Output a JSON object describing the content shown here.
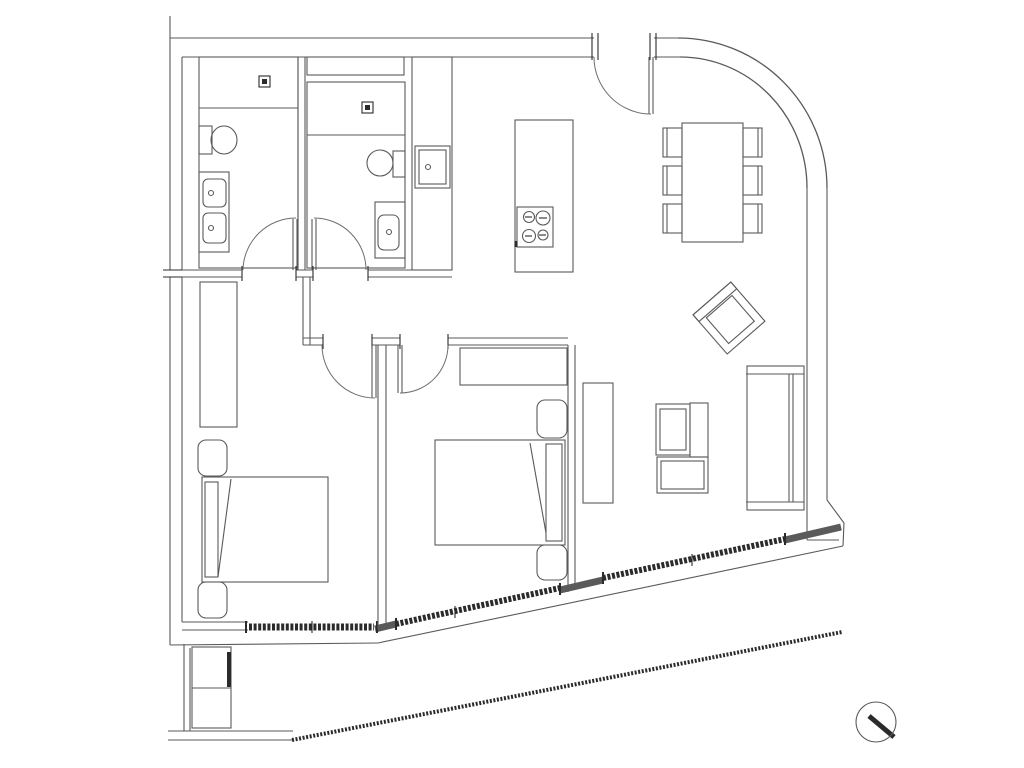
{
  "canvas": {
    "width": 1024,
    "height": 768,
    "background": "#ffffff"
  },
  "style": {
    "line_color": "#5a5a5a",
    "dark_color": "#2b2b2b",
    "arc_color": "#6e6e6e",
    "line_width": 1.1
  },
  "transforms": {
    "armchair": "translate(729,318) rotate(49)"
  },
  "lines": [
    {
      "n": "top-wall-outer-left",
      "x1": 170,
      "y1": 38,
      "x2": 594,
      "y2": 38
    },
    {
      "n": "top-wall-inner-left",
      "x1": 182,
      "y1": 57,
      "x2": 594,
      "y2": 57
    },
    {
      "n": "top-wall-outer-right",
      "x1": 654,
      "y1": 38,
      "x2": 678,
      "y2": 38
    },
    {
      "n": "top-wall-inner-right",
      "x1": 654,
      "y1": 57,
      "x2": 680,
      "y2": 57
    },
    {
      "n": "party-wall-stub",
      "x1": 170,
      "y1": 16,
      "x2": 170,
      "y2": 38
    },
    {
      "n": "left-wall-outer-upper",
      "x1": 170,
      "y1": 38,
      "x2": 170,
      "y2": 270
    },
    {
      "n": "left-wall-outer-lower",
      "x1": 170,
      "y1": 277,
      "x2": 170,
      "y2": 645
    },
    {
      "n": "left-wall-inner-upper",
      "x1": 182,
      "y1": 57,
      "x2": 182,
      "y2": 270
    },
    {
      "n": "left-wall-inner-lower",
      "x1": 182,
      "y1": 277,
      "x2": 182,
      "y2": 622
    },
    {
      "n": "left-wall-break-tick-a",
      "x1": 163,
      "y1": 270,
      "x2": 189,
      "y2": 270,
      "d": 1
    },
    {
      "n": "left-wall-break-tick-b",
      "x1": 163,
      "y1": 277,
      "x2": 189,
      "y2": 277,
      "d": 1
    },
    {
      "n": "right-wall-outer",
      "x1": 827,
      "y1": 188,
      "x2": 827,
      "y2": 500
    },
    {
      "n": "right-wall-inner",
      "x1": 807,
      "y1": 188,
      "x2": 807,
      "y2": 540
    },
    {
      "n": "se-corner-outer",
      "x1": 827,
      "y1": 500,
      "x2": 844,
      "y2": 523
    },
    {
      "n": "se-corner-side",
      "x1": 844,
      "y1": 523,
      "x2": 843,
      "y2": 546
    },
    {
      "n": "se-corner-inner",
      "x1": 807,
      "y1": 540,
      "x2": 839,
      "y2": 540
    },
    {
      "n": "facade-outer-west",
      "x1": 170,
      "y1": 645,
      "x2": 378,
      "y2": 643
    },
    {
      "n": "facade-outer-diag",
      "x1": 378,
      "y1": 643,
      "x2": 843,
      "y2": 546
    },
    {
      "n": "bed1-south-wall-top",
      "x1": 182,
      "y1": 622,
      "x2": 248,
      "y2": 622
    },
    {
      "n": "bed1-south-wall-bot",
      "x1": 182,
      "y1": 630,
      "x2": 248,
      "y2": 630
    },
    {
      "n": "facade-wall-piece-a",
      "x1": 375,
      "y1": 629,
      "x2": 396,
      "y2": 624,
      "w": 7
    },
    {
      "n": "facade-wall-piece-b",
      "x1": 560,
      "y1": 590,
      "x2": 603,
      "y2": 580,
      "w": 7
    },
    {
      "n": "facade-wall-piece-c",
      "x1": 785,
      "y1": 540,
      "x2": 841,
      "y2": 527,
      "w": 7
    },
    {
      "n": "window-bedroom1-band",
      "x1": 249,
      "y1": 627,
      "x2": 374,
      "y2": 627,
      "w": 7,
      "d": 1,
      "dash": "3 1.6"
    },
    {
      "n": "window-bedroom1-cap-left",
      "x1": 246,
      "y1": 621,
      "x2": 246,
      "y2": 633,
      "d": 1,
      "w": 2
    },
    {
      "n": "window-bedroom1-cap-right",
      "x1": 377,
      "y1": 621,
      "x2": 377,
      "y2": 633,
      "d": 1,
      "w": 2
    },
    {
      "n": "window-bedroom1-mullion",
      "x1": 312,
      "y1": 621,
      "x2": 312,
      "y2": 633,
      "d": 1
    },
    {
      "n": "window-bedroom2-band",
      "x1": 396,
      "y1": 624,
      "x2": 560,
      "y2": 588,
      "w": 6,
      "d": 1,
      "dash": "3 1.6"
    },
    {
      "n": "window-bedroom2-cap-left",
      "x1": 396,
      "y1": 618,
      "x2": 396,
      "y2": 630,
      "d": 1,
      "w": 2
    },
    {
      "n": "window-bedroom2-cap-right",
      "x1": 560,
      "y1": 583,
      "x2": 560,
      "y2": 595,
      "d": 1,
      "w": 2
    },
    {
      "n": "window-bedroom2-mullion",
      "x1": 455,
      "y1": 606,
      "x2": 455,
      "y2": 618,
      "d": 1
    },
    {
      "n": "window-living-band",
      "x1": 603,
      "y1": 578,
      "x2": 785,
      "y2": 539,
      "w": 6,
      "d": 1,
      "dash": "3 1.6"
    },
    {
      "n": "window-living-cap-left",
      "x1": 603,
      "y1": 572,
      "x2": 603,
      "y2": 584,
      "d": 1,
      "w": 2
    },
    {
      "n": "window-living-cap-right",
      "x1": 785,
      "y1": 533,
      "x2": 785,
      "y2": 545,
      "d": 1,
      "w": 2
    },
    {
      "n": "window-living-mullion",
      "x1": 692,
      "y1": 554,
      "x2": 692,
      "y2": 566,
      "d": 1
    },
    {
      "n": "balcony-west-wall-a",
      "x1": 184,
      "y1": 644,
      "x2": 184,
      "y2": 731
    },
    {
      "n": "balcony-west-wall-b",
      "x1": 190,
      "y1": 648,
      "x2": 190,
      "y2": 731
    },
    {
      "n": "balcony-south-edge-a",
      "x1": 168,
      "y1": 731,
      "x2": 293,
      "y2": 731
    },
    {
      "n": "balcony-south-edge-b",
      "x1": 168,
      "y1": 740,
      "x2": 293,
      "y2": 740
    },
    {
      "n": "balcony-railing",
      "x1": 292,
      "y1": 740,
      "x2": 842,
      "y2": 632,
      "w": 4,
      "d": 1,
      "dash": "2 1.6"
    },
    {
      "n": "bath-divider-wall-a",
      "x1": 298,
      "y1": 57,
      "x2": 298,
      "y2": 270
    },
    {
      "n": "bath-divider-wall-b",
      "x1": 305,
      "y1": 57,
      "x2": 305,
      "y2": 270
    },
    {
      "n": "bath-south-wall-1a",
      "x1": 182,
      "y1": 270,
      "x2": 242,
      "y2": 270
    },
    {
      "n": "bath-south-wall-1b",
      "x1": 182,
      "y1": 277,
      "x2": 242,
      "y2": 277
    },
    {
      "n": "bath-south-wall-2a",
      "x1": 296,
      "y1": 270,
      "x2": 313,
      "y2": 270
    },
    {
      "n": "bath-south-wall-2b",
      "x1": 296,
      "y1": 277,
      "x2": 313,
      "y2": 277
    },
    {
      "n": "bath-south-wall-3a",
      "x1": 368,
      "y1": 270,
      "x2": 452,
      "y2": 270
    },
    {
      "n": "bath-south-wall-3b",
      "x1": 368,
      "y1": 277,
      "x2": 452,
      "y2": 277
    },
    {
      "n": "bath1-door-jamb-left",
      "x1": 242,
      "y1": 266,
      "x2": 242,
      "y2": 281,
      "d": 1
    },
    {
      "n": "bath1-door-jamb-right",
      "x1": 296,
      "y1": 266,
      "x2": 296,
      "y2": 281,
      "d": 1
    },
    {
      "n": "bath2-door-jamb-left",
      "x1": 313,
      "y1": 266,
      "x2": 313,
      "y2": 281,
      "d": 1
    },
    {
      "n": "bath2-door-jamb-right",
      "x1": 368,
      "y1": 266,
      "x2": 368,
      "y2": 281,
      "d": 1
    },
    {
      "n": "hall-west-wall-a",
      "x1": 303,
      "y1": 277,
      "x2": 303,
      "y2": 345
    },
    {
      "n": "hall-west-wall-b",
      "x1": 310,
      "y1": 277,
      "x2": 310,
      "y2": 345
    },
    {
      "n": "hall-south-wall-1a",
      "x1": 303,
      "y1": 338,
      "x2": 323,
      "y2": 338
    },
    {
      "n": "hall-south-wall-1b",
      "x1": 303,
      "y1": 345,
      "x2": 323,
      "y2": 345
    },
    {
      "n": "hall-south-wall-2a",
      "x1": 372,
      "y1": 338,
      "x2": 400,
      "y2": 338
    },
    {
      "n": "hall-south-wall-2b",
      "x1": 372,
      "y1": 345,
      "x2": 400,
      "y2": 345
    },
    {
      "n": "hall-south-wall-3a",
      "x1": 448,
      "y1": 338,
      "x2": 568,
      "y2": 338
    },
    {
      "n": "hall-south-wall-3b",
      "x1": 448,
      "y1": 345,
      "x2": 568,
      "y2": 345
    },
    {
      "n": "bed1-door-jamb-left",
      "x1": 323,
      "y1": 334,
      "x2": 323,
      "y2": 349,
      "d": 1
    },
    {
      "n": "bed1-door-jamb-right",
      "x1": 372,
      "y1": 334,
      "x2": 372,
      "y2": 349,
      "d": 1
    },
    {
      "n": "bed2-door-jamb-left",
      "x1": 400,
      "y1": 334,
      "x2": 400,
      "y2": 349,
      "d": 1
    },
    {
      "n": "bed2-door-jamb-right",
      "x1": 448,
      "y1": 334,
      "x2": 448,
      "y2": 349,
      "d": 1
    },
    {
      "n": "bedroom-divider-wall-a",
      "x1": 378,
      "y1": 345,
      "x2": 378,
      "y2": 629
    },
    {
      "n": "bedroom-divider-wall-b",
      "x1": 386,
      "y1": 345,
      "x2": 386,
      "y2": 628
    },
    {
      "n": "bed2-east-wall-a",
      "x1": 568,
      "y1": 345,
      "x2": 568,
      "y2": 592
    },
    {
      "n": "bed2-east-wall-b",
      "x1": 575,
      "y1": 345,
      "x2": 575,
      "y2": 590
    },
    {
      "n": "entry-door-jamb-1",
      "x1": 592,
      "y1": 33,
      "x2": 592,
      "y2": 60,
      "d": 1
    },
    {
      "n": "entry-door-jamb-2",
      "x1": 598,
      "y1": 33,
      "x2": 598,
      "y2": 60,
      "d": 1
    },
    {
      "n": "entry-door-jamb-3",
      "x1": 650,
      "y1": 33,
      "x2": 650,
      "y2": 60,
      "d": 1
    },
    {
      "n": "entry-door-jamb-4",
      "x1": 656,
      "y1": 33,
      "x2": 656,
      "y2": 60,
      "d": 1
    },
    {
      "n": "bath1-door-leaf-a",
      "x1": 293,
      "y1": 219,
      "x2": 293,
      "y2": 270
    },
    {
      "n": "bath1-door-leaf-b",
      "x1": 297,
      "y1": 219,
      "x2": 297,
      "y2": 270
    },
    {
      "n": "bath2-door-leaf-a",
      "x1": 312,
      "y1": 219,
      "x2": 312,
      "y2": 270
    },
    {
      "n": "bath2-door-leaf-b",
      "x1": 316,
      "y1": 219,
      "x2": 316,
      "y2": 270
    },
    {
      "n": "bed1-door-leaf-a",
      "x1": 372,
      "y1": 345,
      "x2": 372,
      "y2": 398
    },
    {
      "n": "bed1-door-leaf-b",
      "x1": 376,
      "y1": 345,
      "x2": 376,
      "y2": 398
    },
    {
      "n": "bed2-door-leaf-a",
      "x1": 398,
      "y1": 345,
      "x2": 398,
      "y2": 393
    },
    {
      "n": "bed2-door-leaf-b",
      "x1": 402,
      "y1": 345,
      "x2": 402,
      "y2": 393
    },
    {
      "n": "entry-door-leaf-a",
      "x1": 649,
      "y1": 57,
      "x2": 649,
      "y2": 114
    },
    {
      "n": "entry-door-leaf-b",
      "x1": 653,
      "y1": 57,
      "x2": 653,
      "y2": 114
    },
    {
      "n": "bath1-shower-divider",
      "x1": 199,
      "y1": 108,
      "x2": 298,
      "y2": 108
    },
    {
      "n": "bath2-shower-divider",
      "x1": 307,
      "y1": 135,
      "x2": 405,
      "y2": 135
    },
    {
      "n": "bed1-blanket-fold",
      "x1": 231,
      "y1": 479,
      "x2": 218,
      "y2": 577
    },
    {
      "n": "bed2-blanket-fold",
      "x1": 530,
      "y1": 443,
      "x2": 546,
      "y2": 533
    },
    {
      "n": "sofa-top-cap",
      "x1": 746,
      "y1": 374,
      "x2": 804,
      "y2": 374
    },
    {
      "n": "sofa-bottom-cap",
      "x1": 746,
      "y1": 502,
      "x2": 804,
      "y2": 502
    },
    {
      "n": "sofa-back-a",
      "x1": 789,
      "y1": 374,
      "x2": 789,
      "y2": 502
    },
    {
      "n": "sofa-back-b",
      "x1": 793,
      "y1": 374,
      "x2": 793,
      "y2": 502
    },
    {
      "n": "planter-divider",
      "x1": 192,
      "y1": 688,
      "x2": 231,
      "y2": 688
    },
    {
      "n": "burner-tick-1",
      "x1": 525,
      "y1": 217,
      "x2": 532,
      "y2": 217,
      "d": 1
    },
    {
      "n": "burner-tick-2",
      "x1": 539,
      "y1": 218,
      "x2": 547,
      "y2": 218,
      "d": 1
    },
    {
      "n": "burner-tick-3",
      "x1": 525,
      "y1": 236,
      "x2": 532,
      "y2": 236,
      "d": 1
    },
    {
      "n": "burner-tick-4",
      "x1": 539,
      "y1": 235,
      "x2": 546,
      "y2": 235,
      "d": 1
    },
    {
      "n": "cooktop-notch",
      "x1": 516,
      "y1": 241,
      "x2": 516,
      "y2": 247,
      "d": 1,
      "w": 3
    },
    {
      "n": "chair-back-left-1",
      "x1": 667,
      "y1": 128,
      "x2": 667,
      "y2": 157
    },
    {
      "n": "chair-back-left-2",
      "x1": 667,
      "y1": 166,
      "x2": 667,
      "y2": 195
    },
    {
      "n": "chair-back-left-3",
      "x1": 667,
      "y1": 204,
      "x2": 667,
      "y2": 233
    },
    {
      "n": "chair-back-right-1",
      "x1": 758,
      "y1": 128,
      "x2": 758,
      "y2": 157
    },
    {
      "n": "chair-back-right-2",
      "x1": 758,
      "y1": 166,
      "x2": 758,
      "y2": 195
    },
    {
      "n": "chair-back-right-3",
      "x1": 758,
      "y1": 204,
      "x2": 758,
      "y2": 233
    },
    {
      "n": "compass-needle",
      "x1": 869,
      "y1": 716,
      "x2": 894,
      "y2": 737,
      "w": 5,
      "d": 1
    }
  ],
  "rects": [
    {
      "n": "bathroom1-outline",
      "x": 199,
      "y": 57,
      "w": 99,
      "h": 211
    },
    {
      "n": "bathroom2-niche",
      "x": 307,
      "y": 57,
      "w": 97,
      "h": 18
    },
    {
      "n": "bathroom2-outline",
      "x": 307,
      "y": 82,
      "w": 98,
      "h": 186
    },
    {
      "n": "bath1-shower-drain",
      "x": 259,
      "y": 76,
      "w": 11,
      "h": 11,
      "d": 1
    },
    {
      "n": "bath1-shower-drain-dot",
      "x": 262,
      "y": 79,
      "w": 5,
      "h": 5,
      "fill": 1
    },
    {
      "n": "bath2-shower-drain",
      "x": 362,
      "y": 102,
      "w": 11,
      "h": 11,
      "d": 1
    },
    {
      "n": "bath2-shower-drain-dot",
      "x": 365,
      "y": 105,
      "w": 5,
      "h": 5,
      "fill": 1
    },
    {
      "n": "bath1-toilet-tank",
      "x": 199,
      "y": 126,
      "w": 13,
      "h": 28
    },
    {
      "n": "bath1-vanity-counter",
      "x": 199,
      "y": 172,
      "w": 30,
      "h": 80
    },
    {
      "n": "bath1-basin-1",
      "x": 203,
      "y": 179,
      "w": 23,
      "h": 28,
      "rx": 5
    },
    {
      "n": "bath1-basin-2",
      "x": 203,
      "y": 213,
      "w": 23,
      "h": 30,
      "rx": 5
    },
    {
      "n": "bath2-toilet-tank",
      "x": 393,
      "y": 151,
      "w": 12,
      "h": 26
    },
    {
      "n": "bath2-vanity-counter",
      "x": 375,
      "y": 202,
      "w": 30,
      "h": 56
    },
    {
      "n": "bath2-basin",
      "x": 378,
      "y": 215,
      "w": 21,
      "h": 35,
      "rx": 6
    },
    {
      "n": "kitchen-tall-cabinet",
      "x": 412,
      "y": 57,
      "w": 40,
      "h": 213
    },
    {
      "n": "cabinet-sink-outer",
      "x": 415,
      "y": 146,
      "w": 35,
      "h": 42
    },
    {
      "n": "cabinet-sink-inner",
      "x": 419,
      "y": 150,
      "w": 27,
      "h": 34
    },
    {
      "n": "kitchen-island",
      "x": 515,
      "y": 120,
      "w": 58,
      "h": 152
    },
    {
      "n": "cooktop",
      "x": 517,
      "y": 207,
      "w": 36,
      "h": 40
    },
    {
      "n": "dining-table",
      "x": 682,
      "y": 123,
      "w": 61,
      "h": 119
    },
    {
      "n": "dining-chair-left-1",
      "x": 663,
      "y": 128,
      "w": 19,
      "h": 29
    },
    {
      "n": "dining-chair-left-2",
      "x": 663,
      "y": 166,
      "w": 19,
      "h": 29
    },
    {
      "n": "dining-chair-left-3",
      "x": 663,
      "y": 204,
      "w": 19,
      "h": 29
    },
    {
      "n": "dining-chair-right-1",
      "x": 743,
      "y": 128,
      "w": 19,
      "h": 29
    },
    {
      "n": "dining-chair-right-2",
      "x": 743,
      "y": 166,
      "w": 19,
      "h": 29
    },
    {
      "n": "dining-chair-right-3",
      "x": 743,
      "y": 204,
      "w": 19,
      "h": 29
    },
    {
      "n": "bed1-wardrobe",
      "x": 200,
      "y": 282,
      "w": 37,
      "h": 145
    },
    {
      "n": "bed1-nightstand-north",
      "x": 198,
      "y": 440,
      "w": 29,
      "h": 36,
      "rx": 8
    },
    {
      "n": "bed1-bed",
      "x": 202,
      "y": 477,
      "w": 126,
      "h": 105
    },
    {
      "n": "bed1-pillow",
      "x": 205,
      "y": 482,
      "w": 13,
      "h": 95
    },
    {
      "n": "bed1-nightstand-south",
      "x": 198,
      "y": 582,
      "w": 29,
      "h": 36,
      "rx": 8
    },
    {
      "n": "bed2-wardrobe",
      "x": 460,
      "y": 348,
      "w": 107,
      "h": 37
    },
    {
      "n": "bed2-nightstand-north",
      "x": 537,
      "y": 400,
      "w": 30,
      "h": 38,
      "rx": 8
    },
    {
      "n": "bed2-bed",
      "x": 435,
      "y": 440,
      "w": 130,
      "h": 105
    },
    {
      "n": "bed2-pillow",
      "x": 546,
      "y": 444,
      "w": 16,
      "h": 97
    },
    {
      "n": "bed2-nightstand-south",
      "x": 537,
      "y": 545,
      "w": 30,
      "h": 35,
      "rx": 8
    },
    {
      "n": "tv-console",
      "x": 583,
      "y": 383,
      "w": 30,
      "h": 120
    },
    {
      "n": "sofa-body",
      "x": 747,
      "y": 366,
      "w": 57,
      "h": 144
    },
    {
      "n": "coffee-table-square-outer",
      "x": 656,
      "y": 404,
      "w": 34,
      "h": 51
    },
    {
      "n": "coffee-table-square-inner",
      "x": 660,
      "y": 409,
      "w": 26,
      "h": 41
    },
    {
      "n": "coffee-table-narrow",
      "x": 690,
      "y": 403,
      "w": 18,
      "h": 54
    },
    {
      "n": "coffee-table-low-outer",
      "x": 657,
      "y": 457,
      "w": 51,
      "h": 36
    },
    {
      "n": "coffee-table-low-inner",
      "x": 661,
      "y": 461,
      "w": 43,
      "h": 28
    },
    {
      "n": "armchair-outer",
      "x": -26,
      "y": -25,
      "w": 52,
      "h": 50,
      "tr": "armchair"
    },
    {
      "n": "armchair-seat",
      "x": -15,
      "y": -17,
      "w": 34,
      "h": 34,
      "tr": "armchair"
    },
    {
      "n": "armchair-back",
      "x": -26,
      "y": -25,
      "w": 9,
      "h": 50,
      "tr": "armchair"
    },
    {
      "n": "balcony-planter-box",
      "x": 192,
      "y": 647,
      "w": 39,
      "h": 81
    },
    {
      "n": "balcony-planter-dark-strip",
      "x": 227,
      "y": 652,
      "w": 4,
      "h": 35,
      "fill": 1
    }
  ],
  "ellipses": [
    {
      "n": "bath1-toilet-bowl",
      "cx": 224,
      "cy": 140,
      "rx": 13,
      "ry": 14
    },
    {
      "n": "bath2-toilet-bowl",
      "cx": 380,
      "cy": 163,
      "rx": 13,
      "ry": 13
    }
  ],
  "circles": [
    {
      "n": "bath1-faucet-1",
      "cx": 211,
      "cy": 193,
      "r": 2.5
    },
    {
      "n": "bath1-faucet-2",
      "cx": 211,
      "cy": 228,
      "r": 2.5
    },
    {
      "n": "bath2-faucet",
      "cx": 389,
      "cy": 232,
      "r": 2.5
    },
    {
      "n": "cabinet-sink-faucet",
      "cx": 428,
      "cy": 167,
      "r": 2.5
    },
    {
      "n": "burner-1",
      "cx": 529,
      "cy": 217,
      "r": 5.5
    },
    {
      "n": "burner-2",
      "cx": 543,
      "cy": 218,
      "r": 7
    },
    {
      "n": "burner-3",
      "cx": 529,
      "cy": 236,
      "r": 6.5
    },
    {
      "n": "burner-4",
      "cx": 543,
      "cy": 235,
      "r": 5
    },
    {
      "n": "compass-circle",
      "cx": 876,
      "cy": 722,
      "r": 20
    }
  ],
  "paths": [
    {
      "n": "door-swing-bath1",
      "d": "M 243 270 A 53 53 0 0 1 296 218",
      "arc": 1
    },
    {
      "n": "door-swing-bath2",
      "d": "M 314 218 A 52 52 0 0 1 366 270",
      "arc": 1
    },
    {
      "n": "door-swing-bed1",
      "d": "M 322 345 A 53 53 0 0 0 375 398",
      "arc": 1
    },
    {
      "n": "door-swing-bed2",
      "d": "M 400 393 A 48 48 0 0 0 448 345",
      "arc": 1
    },
    {
      "n": "door-swing-entry",
      "d": "M 594 57 A 57 57 0 0 0 651 114",
      "arc": 1
    },
    {
      "n": "curved-wall-outer",
      "d": "M 678 38 A 149 150 0 0 1 827 188"
    },
    {
      "n": "curved-wall-inner",
      "d": "M 680 57 A 127 131 0 0 1 807 188"
    }
  ]
}
